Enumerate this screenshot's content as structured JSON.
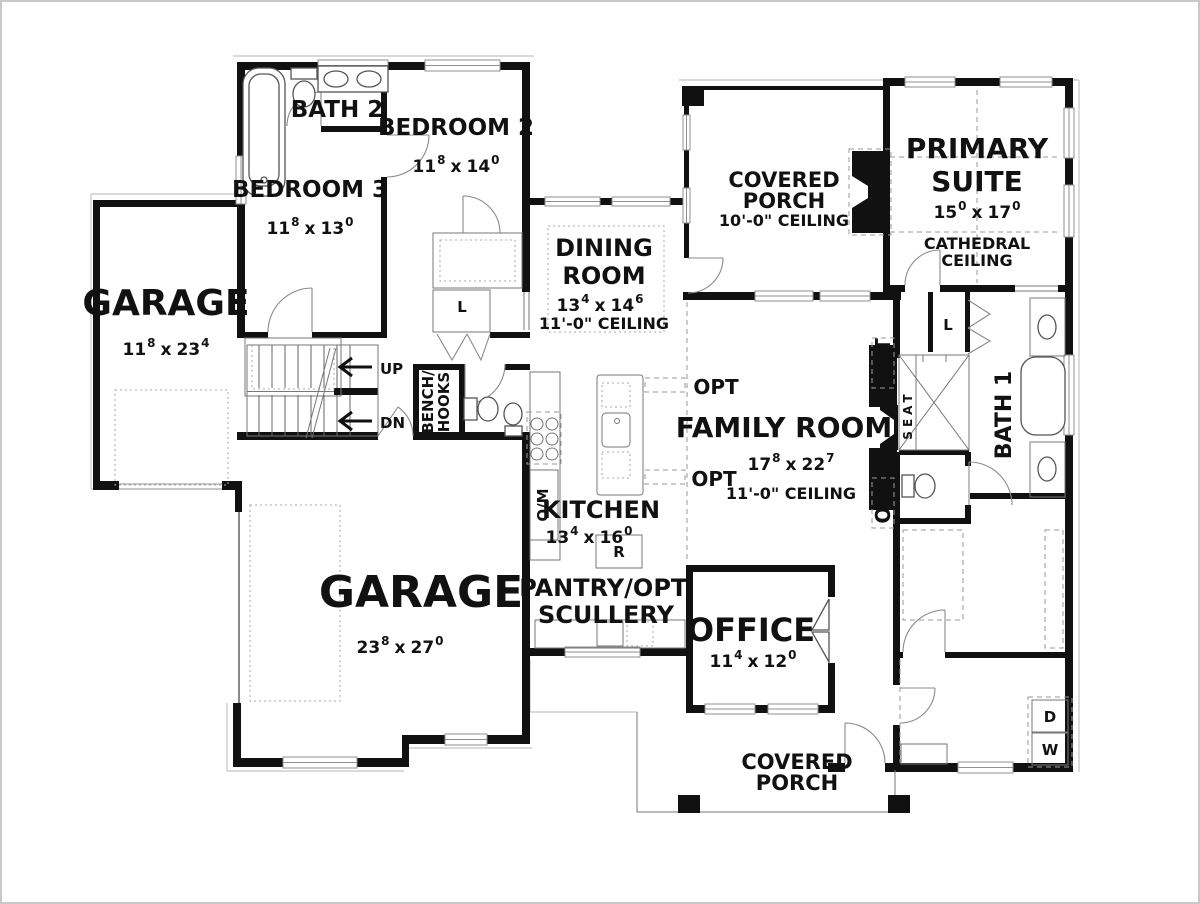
{
  "colors": {
    "wall": "#111111",
    "line": "#555555",
    "muted": "#9a9a9a",
    "text": "#111111",
    "bg": "#ffffff"
  },
  "dim_sep": "x",
  "rooms": {
    "bath2": {
      "name": "BATH 2"
    },
    "bedroom2": {
      "name": "BEDROOM 2",
      "dim": {
        "a": "11",
        "asup": "8",
        "b": "14",
        "bsup": "0"
      }
    },
    "bedroom3": {
      "name": "BEDROOM 3",
      "dim": {
        "a": "11",
        "asup": "8",
        "b": "13",
        "bsup": "0"
      }
    },
    "garage_left": {
      "name": "GARAGE",
      "dim": {
        "a": "11",
        "asup": "8",
        "b": "23",
        "bsup": "4"
      }
    },
    "garage_main": {
      "name": "GARAGE",
      "dim": {
        "a": "23",
        "asup": "8",
        "b": "27",
        "bsup": "0"
      }
    },
    "dining": {
      "line1": "DINING",
      "line2": "ROOM",
      "dim": {
        "a": "13",
        "asup": "4",
        "b": "14",
        "bsup": "6"
      },
      "ceiling": "11'-0\" CEILING"
    },
    "kitchen": {
      "name": "KITCHEN",
      "dim": {
        "a": "13",
        "asup": "4",
        "b": "16",
        "bsup": "0"
      }
    },
    "pantry": {
      "line1": "PANTRY/OPT.",
      "line2": "SCULLERY"
    },
    "office": {
      "name": "OFFICE",
      "dim": {
        "a": "11",
        "asup": "4",
        "b": "12",
        "bsup": "0"
      }
    },
    "family": {
      "name": "FAMILY ROOM",
      "dim": {
        "a": "17",
        "asup": "8",
        "b": "22",
        "bsup": "7"
      },
      "ceiling": "11'-0\" CEILING"
    },
    "primary": {
      "line1": "PRIMARY",
      "line2": "SUITE",
      "dim": {
        "a": "15",
        "asup": "0",
        "b": "17",
        "bsup": "0"
      },
      "ceiling1": "CATHEDRAL",
      "ceiling2": "CEILING"
    },
    "bath1": {
      "name": "BATH 1"
    },
    "porch_top": {
      "line1": "COVERED",
      "line2": "PORCH",
      "ceiling": "10'-0\" CEILING"
    },
    "porch_bottom": {
      "line1": "COVERED",
      "line2": "PORCH"
    }
  },
  "labels": {
    "up": "UP",
    "down": "DN",
    "bench_line1": "BENCH/",
    "bench_line2": "HOOKS",
    "oven_micro": "O/M",
    "refrigerator": "R",
    "linen": "L",
    "dryer": "D",
    "washer": "W",
    "seat": "SEAT",
    "opt": "OPT"
  }
}
